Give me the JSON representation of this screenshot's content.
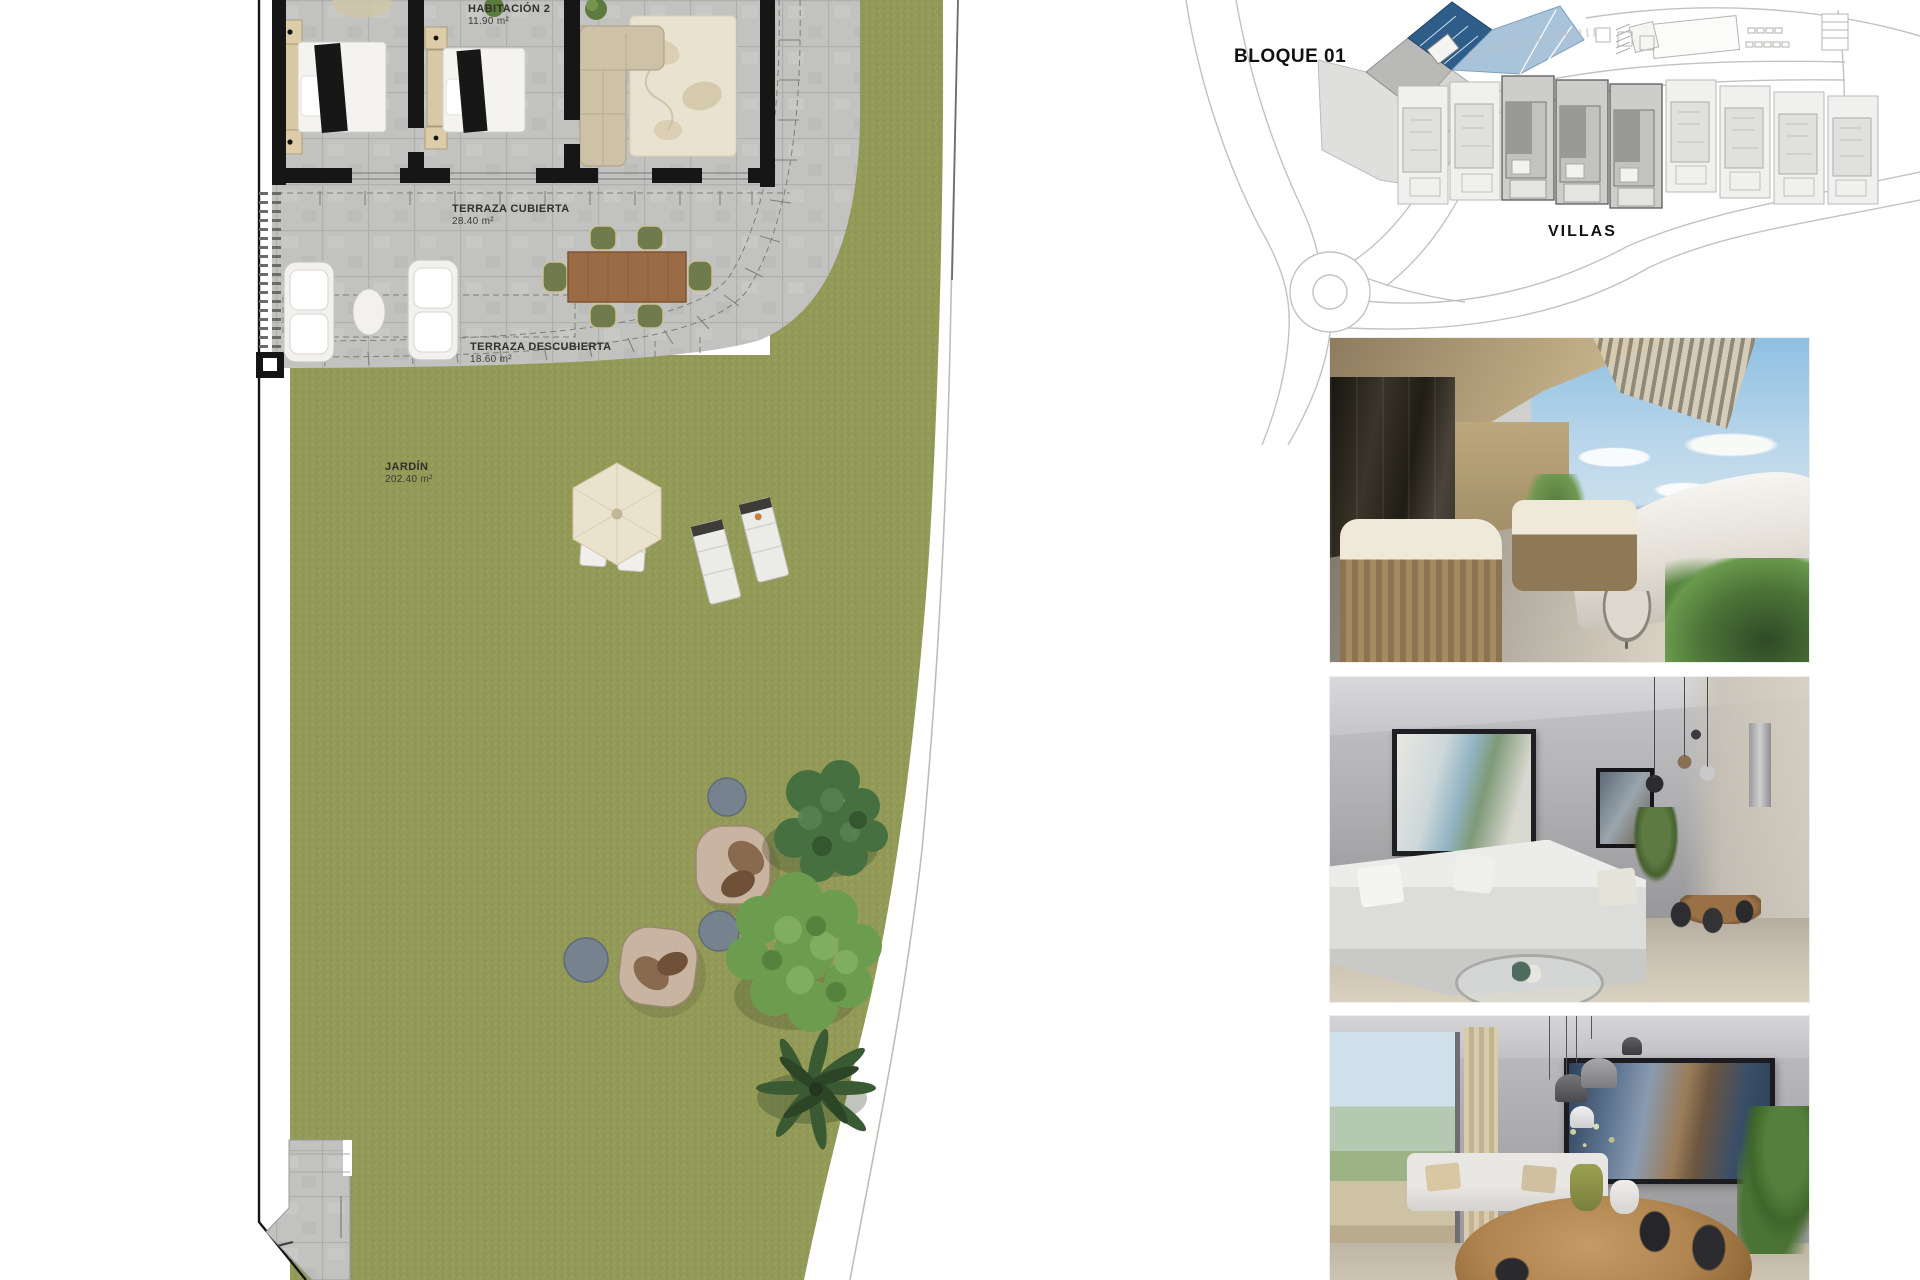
{
  "page": {
    "background": "#ffffff"
  },
  "floor_plan": {
    "habitacion2_label": "HABITACIÓN 2",
    "habitacion2_area": "11.90 m²",
    "terraza_cubierta_label": "TERRAZA CUBIERTA",
    "terraza_cubierta_area": "28.40 m²",
    "terraza_descubierta_label": "TERRAZA DESCUBIERTA",
    "terraza_descubierta_area": "18.60 m²",
    "jardin_label": "JARDÍN",
    "jardin_area": "202.40 m²"
  },
  "site_plan": {
    "bloque_label": "BLOQUE 01",
    "villas_label": "VILLAS"
  },
  "colors": {
    "grass": "#939a58",
    "paving": "#c2c2c1",
    "wall": "#161616",
    "wood_table": "#9a6b45",
    "bloque_blue_dark": "#2f5d8a",
    "bloque_blue_light": "#a9c3da"
  }
}
